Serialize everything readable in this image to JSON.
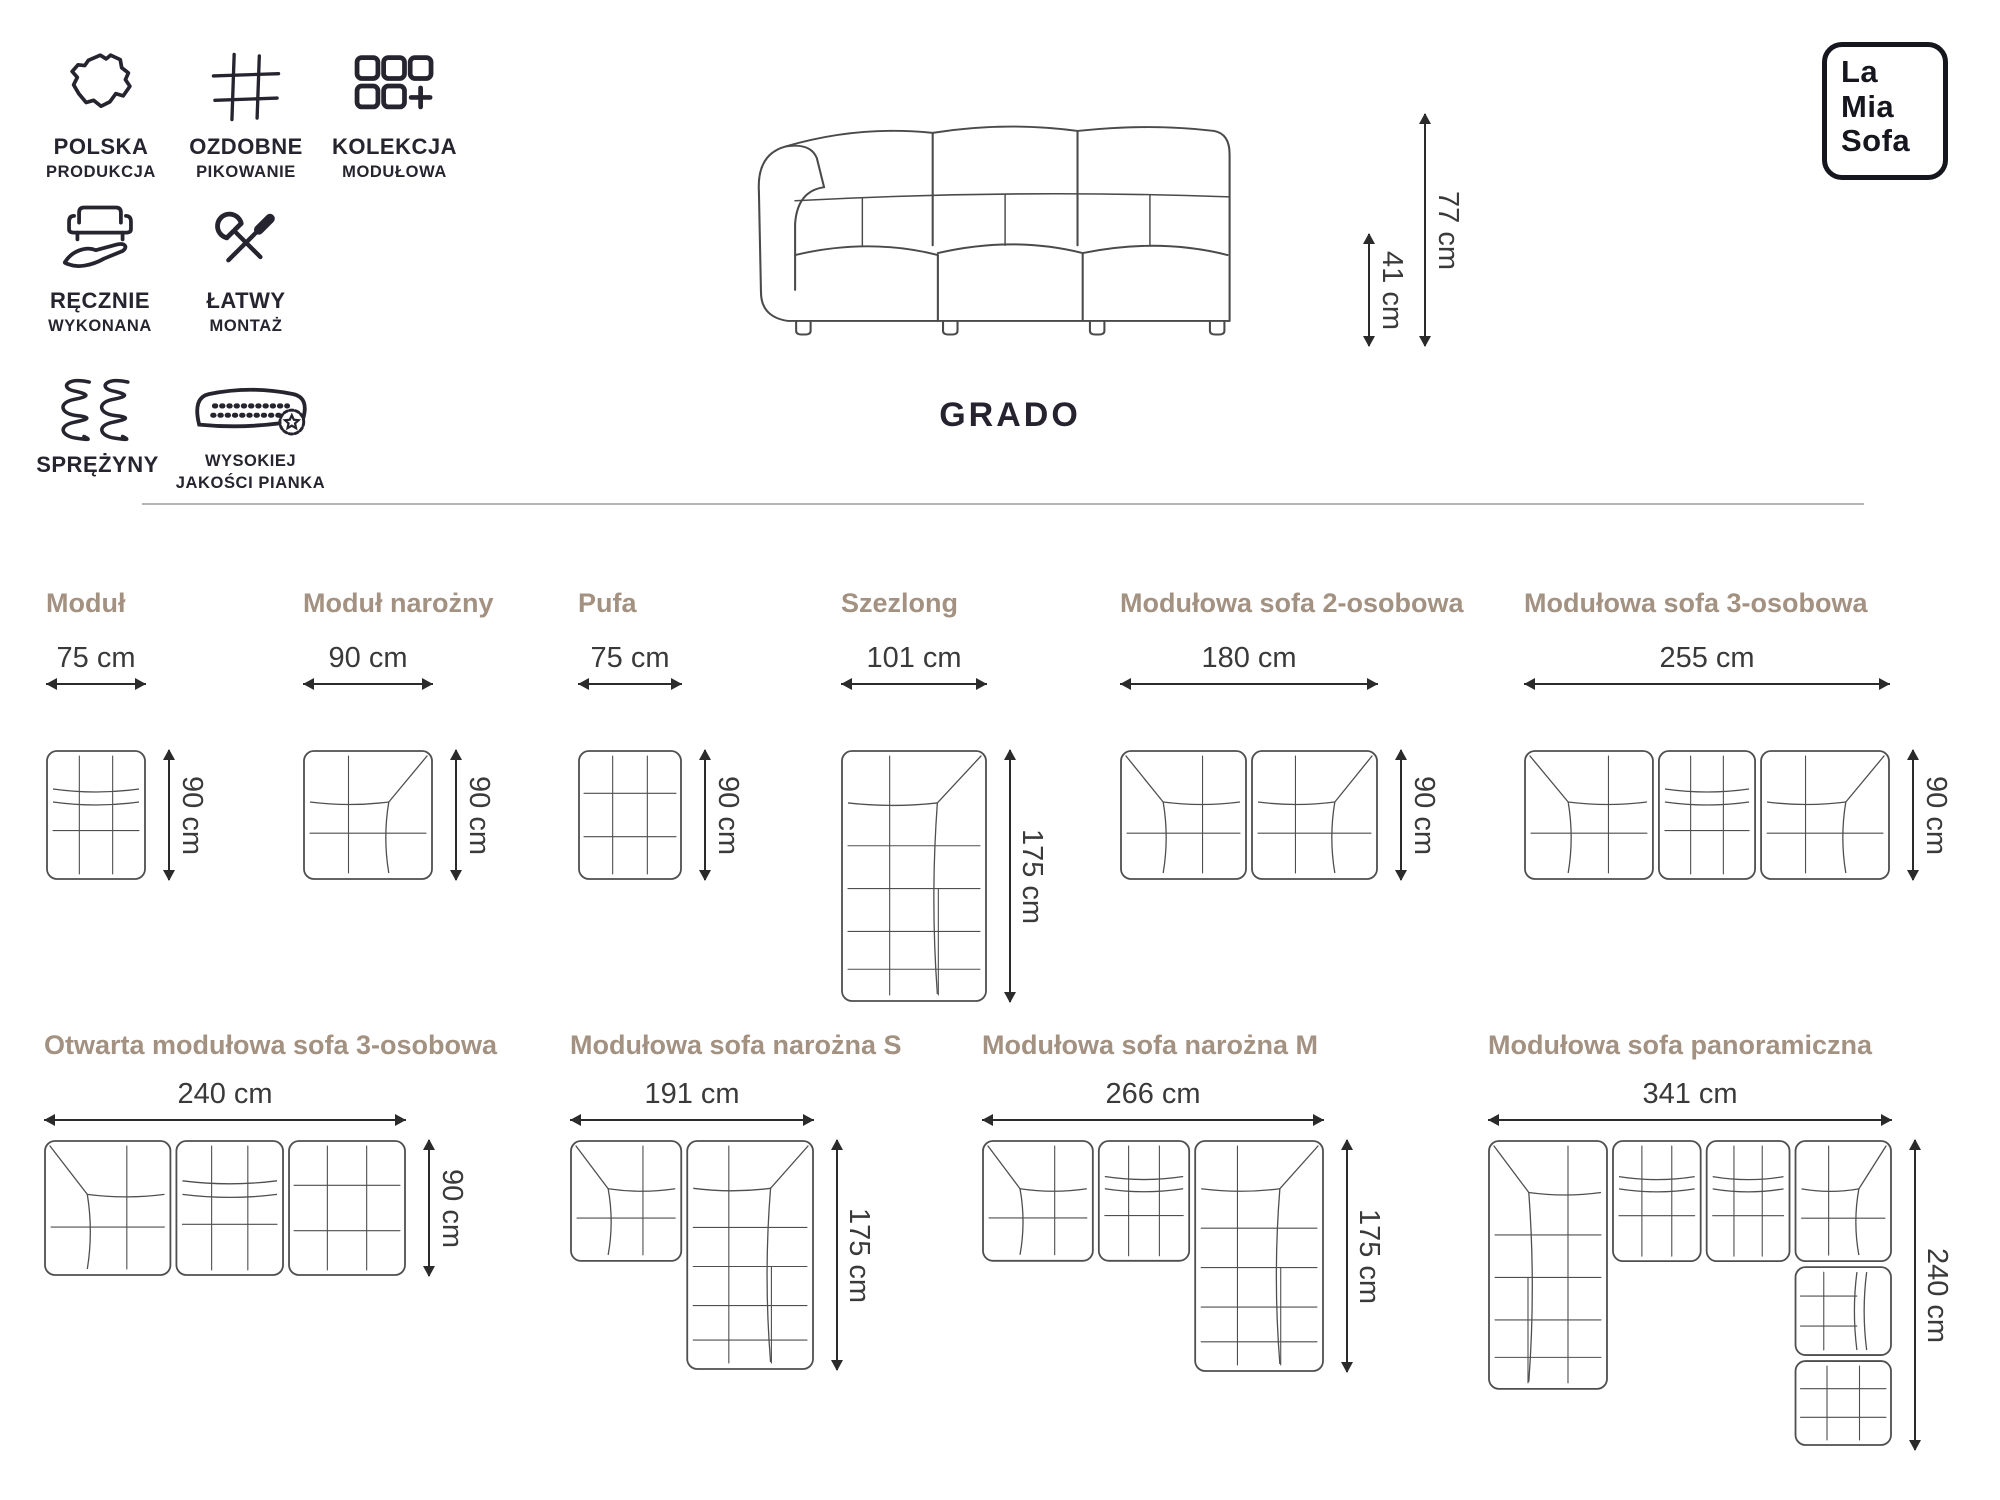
{
  "brand": {
    "logo_lines": [
      "La",
      "Mia",
      "Sofa"
    ]
  },
  "product": {
    "name": "GRADO",
    "total_height_label": "77 cm",
    "seat_height_label": "41 cm"
  },
  "features": [
    {
      "icon": "poland-map-icon",
      "line1": "POLSKA",
      "line2": "PRODUKCJA"
    },
    {
      "icon": "quilting-grid-icon",
      "line1": "OZDOBNE",
      "line2": "PIKOWANIE"
    },
    {
      "icon": "modules-icon",
      "line1": "KOLEKCJA",
      "line2": "MODUŁOWA"
    },
    {
      "icon": "handmade-icon",
      "line1": "RĘCZNIE",
      "line2": "WYKONANA"
    },
    {
      "icon": "tools-icon",
      "line1": "ŁATWY",
      "line2": "MONTAŻ"
    },
    {
      "icon": "springs-icon",
      "line1": "SPRĘŻYNY",
      "line2": ""
    },
    {
      "icon": "foam-badge-icon",
      "line1": "WYSOKIEJ",
      "line2": "JAKOŚCI PIANKA"
    }
  ],
  "modules_row1": [
    {
      "title": "Moduł",
      "width_label": "75 cm",
      "height_label": "90 cm"
    },
    {
      "title": "Moduł narożny",
      "width_label": "90 cm",
      "height_label": "90 cm"
    },
    {
      "title": "Pufa",
      "width_label": "75 cm",
      "height_label": "90 cm"
    },
    {
      "title": "Szezlong",
      "width_label": "101 cm",
      "height_label": "175 cm"
    },
    {
      "title": "Modułowa sofa 2-osobowa",
      "width_label": "180 cm",
      "height_label": "90 cm"
    },
    {
      "title": "Modułowa sofa 3-osobowa",
      "width_label": "255 cm",
      "height_label": "90 cm"
    }
  ],
  "modules_row2": [
    {
      "title": "Otwarta modułowa sofa 3-osobowa",
      "width_label": "240 cm",
      "height_label": "90 cm"
    },
    {
      "title": "Modułowa sofa narożna S",
      "width_label": "191 cm",
      "height_label": "175 cm"
    },
    {
      "title": "Modułowa sofa narożna M",
      "width_label": "266 cm",
      "height_label": "175 cm"
    },
    {
      "title": "Modułowa sofa panoramiczna",
      "width_label": "341 cm",
      "height_label": "240 cm"
    }
  ],
  "colors": {
    "title_taupe": "#a39181",
    "text_dark": "#26242e",
    "dimension_text": "#3a3a3a",
    "line_art": "#4f4f4f",
    "divider": "#b5b5b5",
    "background": "#ffffff"
  }
}
